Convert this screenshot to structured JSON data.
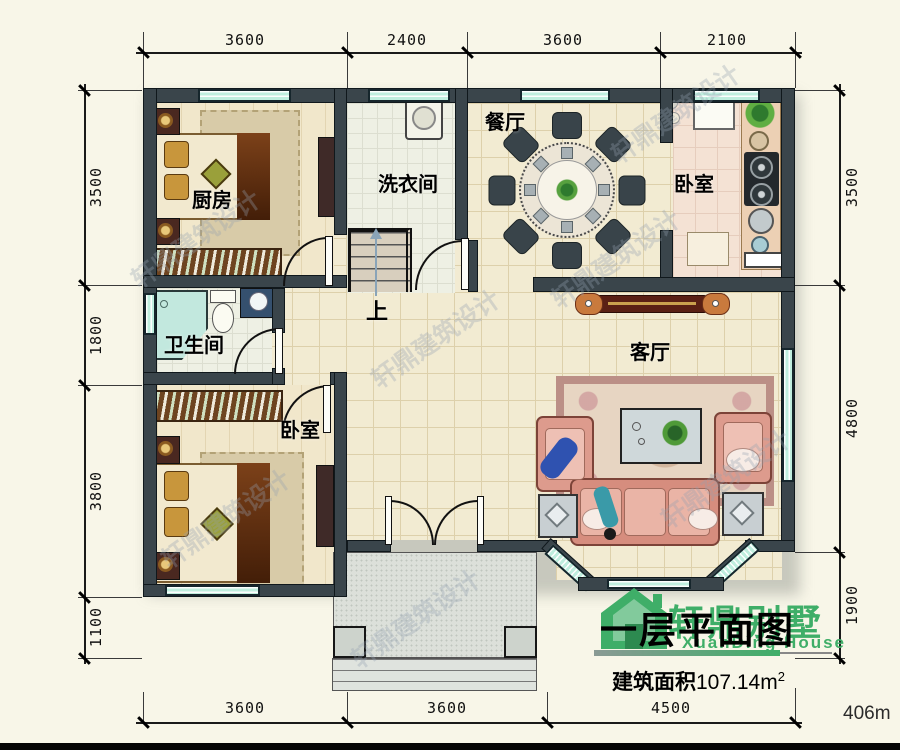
{
  "plan": {
    "title": "一层平面图",
    "brand_cn": "轩鼎别墅",
    "brand_en": "XuanDing House",
    "area_label": "建筑面积",
    "area_value": "107.14m",
    "area_exp": "2",
    "corner_note": "406m",
    "watermark": "轩鼎建筑设计",
    "stairs_up": "上"
  },
  "rooms": {
    "kitchen": "厨房",
    "laundry": "洗衣间",
    "dining": "餐厅",
    "bedroom_tr": "卧室",
    "bathroom": "卫生间",
    "bedroom_bl": "卧室",
    "living": "客厅"
  },
  "dimensions": {
    "top": [
      "3600",
      "2400",
      "3600",
      "2100"
    ],
    "bottom": [
      "3600",
      "3600",
      "4500"
    ],
    "left": [
      "3500",
      "1800",
      "3800",
      "1100"
    ],
    "right": [
      "3500",
      "4800",
      "1900"
    ]
  },
  "colors": {
    "wall": "#3a454b",
    "window": "#bfeede",
    "brand_green": "#3fae68",
    "floor": "#f2ebd2"
  }
}
